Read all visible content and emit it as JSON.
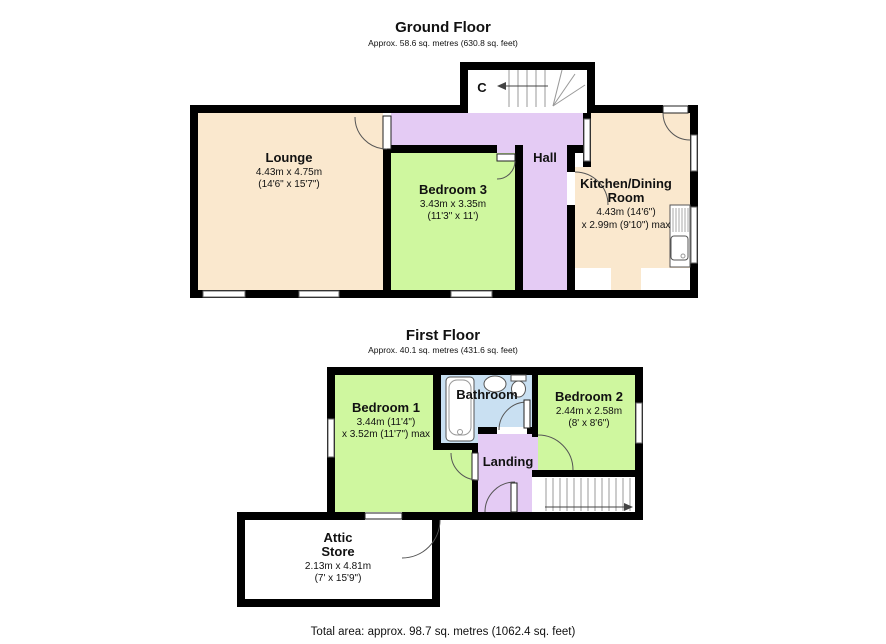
{
  "colors": {
    "wall": "#000000",
    "room_cream": "#fae8ce",
    "room_green": "#cff79f",
    "room_lavender": "#e4cbf4",
    "room_blue": "#c9e0f2"
  },
  "ground_floor": {
    "title": "Ground Floor",
    "subtitle": "Approx. 58.6 sq. metres (630.8 sq. feet)",
    "rooms": {
      "lounge": {
        "name": "Lounge",
        "dims_metric": "4.43m x 4.75m",
        "dims_imperial": "(14'6\" x 15'7\")"
      },
      "bedroom3": {
        "name": "Bedroom 3",
        "dims_metric": "3.43m x 3.35m",
        "dims_imperial": "(11'3\" x 11')"
      },
      "hall": {
        "name": "Hall"
      },
      "cupboard": {
        "name": "C"
      },
      "kitchen": {
        "name_line1": "Kitchen/Dining",
        "name_line2": "Room",
        "dims_metric": "4.43m (14'6\")",
        "dims_imperial": "x 2.99m (9'10\") max"
      }
    }
  },
  "first_floor": {
    "title": "First Floor",
    "subtitle": "Approx. 40.1 sq. metres (431.6 sq. feet)",
    "rooms": {
      "bedroom1": {
        "name": "Bedroom 1",
        "dims_metric": "3.44m (11'4\")",
        "dims_imperial": "x 3.52m (11'7\") max"
      },
      "bathroom": {
        "name": "Bathroom"
      },
      "bedroom2": {
        "name": "Bedroom 2",
        "dims_metric": "2.44m x 2.58m",
        "dims_imperial": "(8' x 8'6\")"
      },
      "landing": {
        "name": "Landing"
      },
      "attic": {
        "name_line1": "Attic",
        "name_line2": "Store",
        "dims_metric": "2.13m x 4.81m",
        "dims_imperial": "(7' x 15'9\")"
      }
    }
  },
  "footer": {
    "total_area": "Total area: approx. 98.7 sq. metres (1062.4 sq. feet)"
  }
}
